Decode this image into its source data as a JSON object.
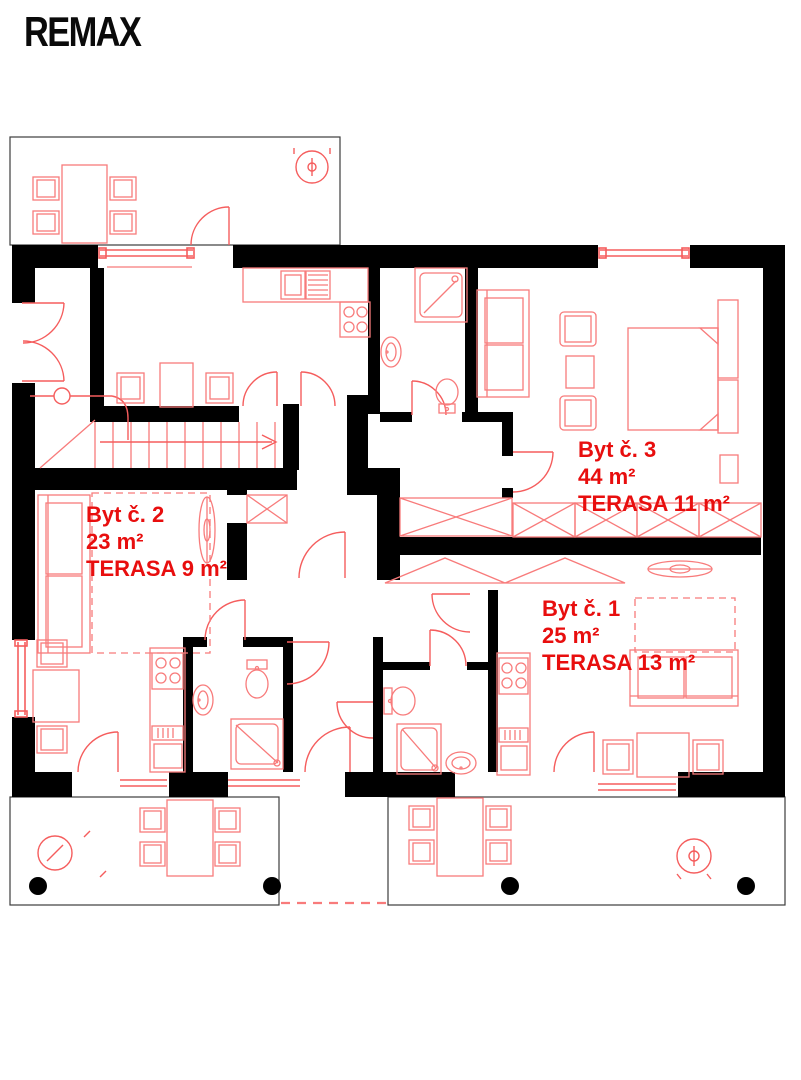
{
  "logo": {
    "text": "REMAX"
  },
  "apartments": [
    {
      "name": "Byt č. 1",
      "area": "25 m²",
      "terrace": "TERASA 13 m²"
    },
    {
      "name": "Byt č. 2",
      "area": "23 m²",
      "terrace": "TERASA 9 m²"
    },
    {
      "name": "Byt č. 3",
      "area": "44 m²",
      "terrace": "TERASA 11 m²"
    }
  ],
  "colors": {
    "wall": "#000000",
    "line": "#f87b7b",
    "accent": "#f55d5d",
    "label": "#e80e0e",
    "terrace_outline": "#3d3d3d",
    "background": "#ffffff",
    "logo": "#0a0a0a"
  },
  "icons": [
    "ceiling-light-icon",
    "stove-icon",
    "sink-icon",
    "toilet-icon",
    "shower-icon",
    "sofa-icon",
    "bed-icon",
    "table-icon",
    "chair-icon",
    "stairs-icon",
    "door-swing-icon",
    "window-icon",
    "pergola-icon"
  ]
}
